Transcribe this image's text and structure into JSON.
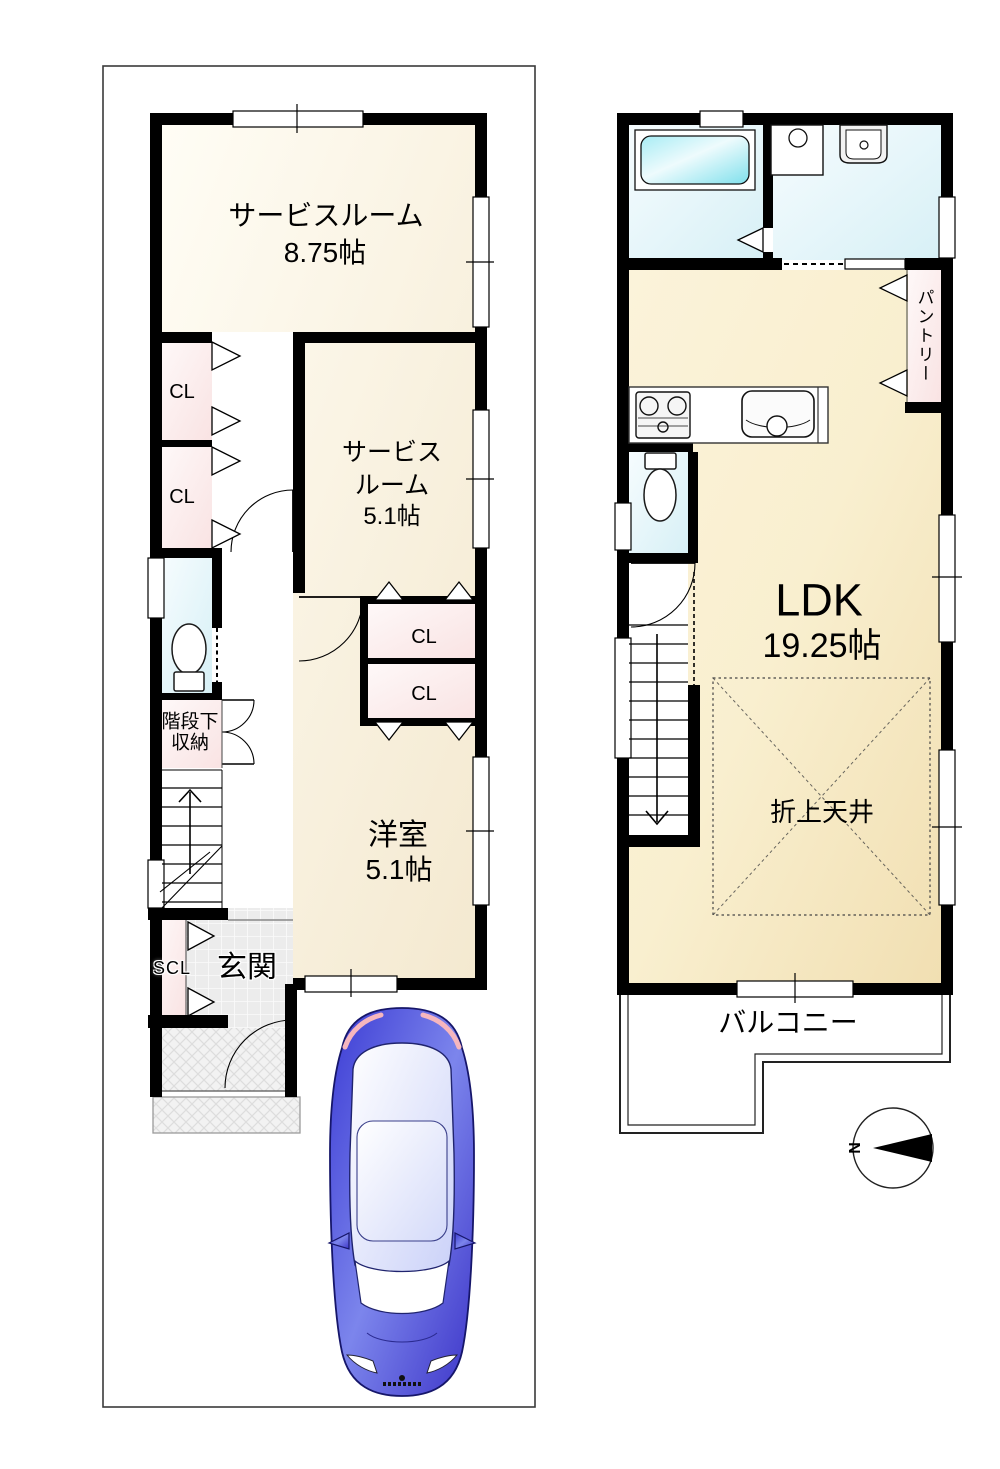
{
  "floor1": {
    "service_room_large": {
      "name": "サービスルーム",
      "area": "8.75帖"
    },
    "service_room_small": {
      "name_line1": "サービス",
      "name_line2": "ルーム",
      "area": "5.1帖"
    },
    "western_room": {
      "name": "洋室",
      "area": "5.1帖"
    },
    "closet_left_upper": "CL",
    "closet_left_lower": "CL",
    "closet_mid_upper": "CL",
    "closet_mid_lower": "CL",
    "under_stair_storage": {
      "line1": "階段下",
      "line2": "収納"
    },
    "shoe_closet": "SCL",
    "entrance": "玄関"
  },
  "floor2": {
    "ldk": {
      "name": "LDK",
      "area": "19.25帖"
    },
    "pantry": "パントリー",
    "coffered_ceiling": "折上天井",
    "balcony": "バルコニー"
  },
  "compass": {
    "north_label": "N"
  },
  "colors": {
    "wall": "#000000",
    "room_cream": "#f6ecd4",
    "ldk_tan": "#f3e2b8",
    "closet_pink": "#fae7e7",
    "water_cyan": "#d9f1f7",
    "bathtub_cyan": "#8ae4ef",
    "car_blue": "#4646d8"
  }
}
